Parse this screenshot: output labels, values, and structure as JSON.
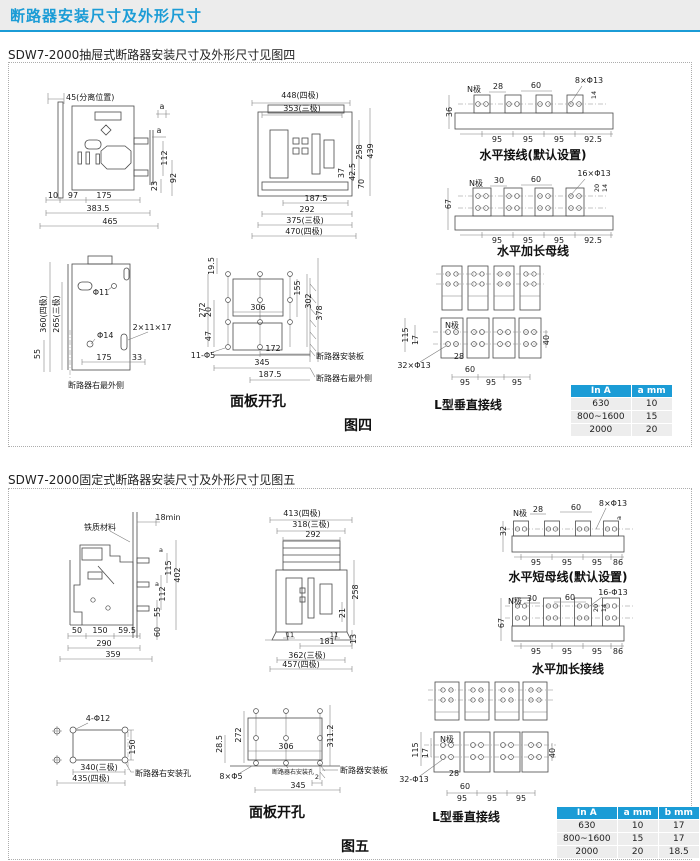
{
  "header": {
    "title": "断路器安装尺寸及外形尺寸",
    "accent_color": "#1b9cd6"
  },
  "fig4": {
    "heading": "SDW7-2000抽屉式断路器安装尺寸及外形尺寸见图四",
    "caption": "图四",
    "side": {
      "sep": "45(分离位置)",
      "a1": "a",
      "a2": "a",
      "v112": "112",
      "v23": "23",
      "v92": "92",
      "b10": "10",
      "b97": "97",
      "b175": "175",
      "b3835": "383.5",
      "b465": "465"
    },
    "front": {
      "t448": "448(四极)",
      "t353": "353(三极)",
      "r258": "258",
      "r439": "439",
      "r37": "37",
      "r425": "42.5",
      "r70": "70",
      "b1875": "187.5",
      "b292": "292",
      "b375": "375(三极)",
      "b470": "470(四极)"
    },
    "hw": {
      "cap": "水平接线(默认设置)",
      "n": "N极",
      "d28": "28",
      "d60": "60",
      "holes": "8×Φ13",
      "d14": "14",
      "d36": "36",
      "p1": "95",
      "p2": "95",
      "p3": "95",
      "p4": "92.5"
    },
    "hb": {
      "cap": "水平加长母线",
      "n": "N极",
      "d30": "30",
      "d60": "60",
      "holes": "16×Φ13",
      "d20": "20",
      "d14": "14",
      "d67": "67",
      "p1": "95",
      "p2": "95",
      "p3": "95",
      "p4": "92.5"
    },
    "rside": {
      "v360": "360(四极)",
      "v265": "265(三极)",
      "phi11": "Φ11",
      "phi14": "Φ14",
      "slot": "2×11×17",
      "v55": "55",
      "b175": "175",
      "b33": "33",
      "cap": "断路器右最外侧"
    },
    "panel": {
      "cap": "面板开孔",
      "v195": "19.5",
      "v272": "272",
      "v20": "20",
      "v47": "47",
      "w306": "306",
      "r155": "155",
      "r302": "302",
      "r378": "378",
      "holes": "11-Φ5",
      "b172": "172",
      "b345": "345",
      "b1875": "187.5",
      "plate": "断路器安装板",
      "redge": "断路器右最外侧"
    },
    "lv": {
      "cap": "L型垂直接线",
      "n": "N极",
      "v115": "115",
      "v17": "17",
      "holes": "32×Φ13",
      "d28": "28",
      "d60": "60",
      "p1": "95",
      "p2": "95",
      "p3": "95",
      "v40": "40"
    },
    "table": {
      "headers": [
        "In A",
        "a mm"
      ],
      "rows": [
        [
          "630",
          "10"
        ],
        [
          "800~1600",
          "15"
        ],
        [
          "2000",
          "20"
        ]
      ]
    }
  },
  "fig5": {
    "heading": "SDW7-2000固定式断路器安装尺寸及外形尺寸见图五",
    "caption": "图五",
    "side": {
      "mat": "铁质材料",
      "min18": "18min",
      "a1": "a",
      "v115": "115",
      "v402": "402",
      "v112": "112",
      "a2": "a",
      "v55": "55",
      "v60": "60",
      "b50": "50",
      "b150": "150",
      "b595": "59.5",
      "b290": "290",
      "b359": "359"
    },
    "front": {
      "t413": "413(四极)",
      "t318": "318(三极)",
      "t292": "292",
      "r258": "258",
      "r21": "21",
      "r13": "13",
      "b11a": "11",
      "b11b": "11",
      "b181": "181",
      "b362": "362(三极)",
      "b457": "457(四极)"
    },
    "hw": {
      "cap": "水平短母线(默认设置)",
      "n": "N极",
      "d28": "28",
      "d60": "60",
      "holes": "8×Φ13",
      "a": "a",
      "d32": "32",
      "p1": "95",
      "p2": "95",
      "p3": "95",
      "p4": "86"
    },
    "hb": {
      "cap": "水平加长接线",
      "n": "N极",
      "d30": "30",
      "d60": "60",
      "holes": "16-Φ13",
      "d20": "20",
      "d14": "14",
      "d67": "67",
      "p1": "95",
      "p2": "95",
      "p3": "95",
      "p4": "86"
    },
    "mount": {
      "holes": "4-Φ12",
      "v150": "150",
      "b340": "340(三极)",
      "b435": "435(四极)",
      "label": "断路器右安装孔"
    },
    "panel": {
      "cap": "面板开孔",
      "v285": "28.5",
      "v272": "272",
      "w306": "306",
      "r3112": "311.2",
      "holes": "8×Φ5",
      "d2": "2",
      "b345": "345",
      "small": "断路器右安装孔",
      "plate": "断路器安装板"
    },
    "lv": {
      "cap": "L型垂直接线",
      "n": "N极",
      "v115": "115",
      "v17": "17",
      "holes": "32-Φ13",
      "d28": "28",
      "d60": "60",
      "p1": "95",
      "p2": "95",
      "p3": "95",
      "v40": "40"
    },
    "table": {
      "headers": [
        "In A",
        "a mm",
        "b mm"
      ],
      "rows": [
        [
          "630",
          "10",
          "17"
        ],
        [
          "800~1600",
          "15",
          "17"
        ],
        [
          "2000",
          "20",
          "18.5"
        ]
      ]
    }
  }
}
